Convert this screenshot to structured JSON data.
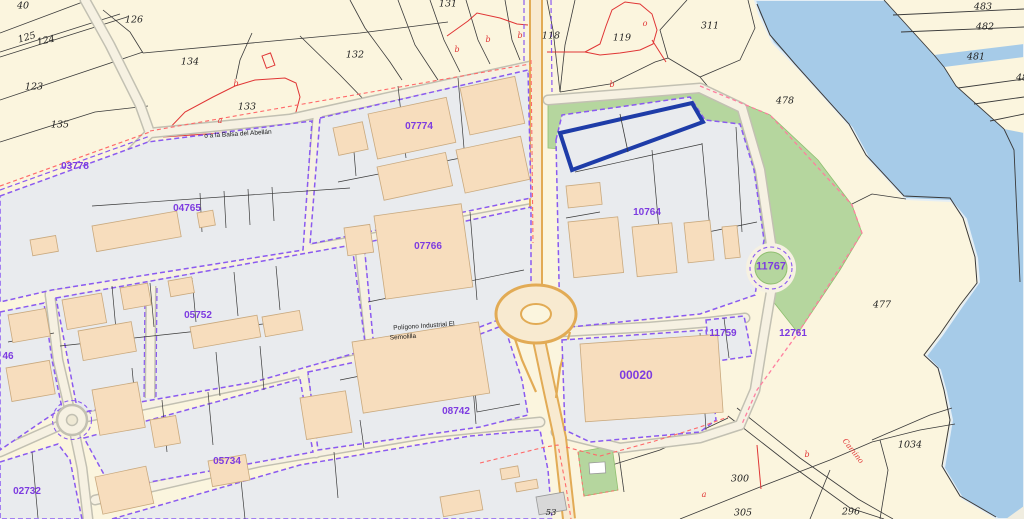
{
  "map": {
    "description": "Cadastral parcel map with industrial estate, rural parcels and water body",
    "block_labels": [
      {
        "text": "03778",
        "x": 75,
        "y": 167
      },
      {
        "text": "07774",
        "x": 419,
        "y": 127
      },
      {
        "text": "04765",
        "x": 187,
        "y": 209
      },
      {
        "text": "07766",
        "x": 428,
        "y": 247
      },
      {
        "text": "05752",
        "x": 198,
        "y": 316
      },
      {
        "text": "10764",
        "x": 647,
        "y": 213
      },
      {
        "text": "11767",
        "x": 771,
        "y": 267,
        "size": 11
      },
      {
        "text": "11759",
        "x": 723,
        "y": 334
      },
      {
        "text": "12761",
        "x": 793,
        "y": 334
      },
      {
        "text": "00020",
        "x": 636,
        "y": 375,
        "size": 12
      },
      {
        "text": "08742",
        "x": 456,
        "y": 412
      },
      {
        "text": "05734",
        "x": 227,
        "y": 462
      },
      {
        "text": "02732",
        "x": 27,
        "y": 492
      },
      {
        "text": "46",
        "x": 8,
        "y": 357
      }
    ],
    "rural_numbers": [
      {
        "text": "40",
        "x": 23,
        "y": 6
      },
      {
        "text": "126",
        "x": 134,
        "y": 20
      },
      {
        "text": "125",
        "x": 27,
        "y": 38,
        "rot": -16
      },
      {
        "text": "124",
        "x": 46,
        "y": 41,
        "rot": -12
      },
      {
        "text": "123",
        "x": 34,
        "y": 87
      },
      {
        "text": "135",
        "x": 60,
        "y": 125
      },
      {
        "text": "134",
        "x": 190,
        "y": 62
      },
      {
        "text": "133",
        "x": 247,
        "y": 107
      },
      {
        "text": "132",
        "x": 355,
        "y": 55
      },
      {
        "text": "131",
        "x": 448,
        "y": 4
      },
      {
        "text": "118",
        "x": 551,
        "y": 36
      },
      {
        "text": "119",
        "x": 622,
        "y": 38
      },
      {
        "text": "311",
        "x": 710,
        "y": 26
      },
      {
        "text": "483",
        "x": 983,
        "y": 7
      },
      {
        "text": "482",
        "x": 985,
        "y": 27
      },
      {
        "text": "481",
        "x": 976,
        "y": 57
      },
      {
        "text": "48",
        "x": 1022,
        "y": 78
      },
      {
        "text": "478",
        "x": 785,
        "y": 101
      },
      {
        "text": "477",
        "x": 882,
        "y": 305
      },
      {
        "text": "1034",
        "x": 910,
        "y": 445
      },
      {
        "text": "300",
        "x": 740,
        "y": 479
      },
      {
        "text": "305",
        "x": 743,
        "y": 513
      },
      {
        "text": "296",
        "x": 851,
        "y": 512
      },
      {
        "text": "53",
        "x": 551,
        "y": 513,
        "size": 8.5
      }
    ],
    "red_marks": [
      {
        "text": "b",
        "x": 236,
        "y": 84
      },
      {
        "text": "a",
        "x": 220,
        "y": 121
      },
      {
        "text": "b",
        "x": 457,
        "y": 50
      },
      {
        "text": "b",
        "x": 488,
        "y": 40
      },
      {
        "text": "b",
        "x": 520,
        "y": 36
      },
      {
        "text": "o",
        "x": 645,
        "y": 24
      },
      {
        "text": "b",
        "x": 612,
        "y": 85
      },
      {
        "text": "a",
        "x": 704,
        "y": 495
      },
      {
        "text": "b",
        "x": 807,
        "y": 455
      },
      {
        "text": "Camino",
        "x": 853,
        "y": 451,
        "rot": 52,
        "size": 7.5
      }
    ],
    "road_names": [
      {
        "text": "o a la Balsa del Abellán",
        "x": 238,
        "y": 135,
        "rot": -3.5
      },
      {
        "text": "Polígono Industrial El",
        "x": 424,
        "y": 327,
        "rot": -4
      },
      {
        "text": "Semolilla",
        "x": 403,
        "y": 338,
        "rot": -4
      }
    ],
    "colors": {
      "land": "#fbf5de",
      "water": "#a6cbe8",
      "urban_block": "#e9ebee",
      "building": "#f7ddbd",
      "green_zone": "#b5d69e",
      "road_fill": "#f6f1e2",
      "highway_casing": "#e2ab55",
      "parcel_line": "#3a3a3a",
      "urban_boundary_purple": "#8a5af0",
      "perimeter_red": "#ff6a6a",
      "label_purple": "#7d3be0",
      "selected_parcel_outline": "#1e3ca8"
    }
  }
}
